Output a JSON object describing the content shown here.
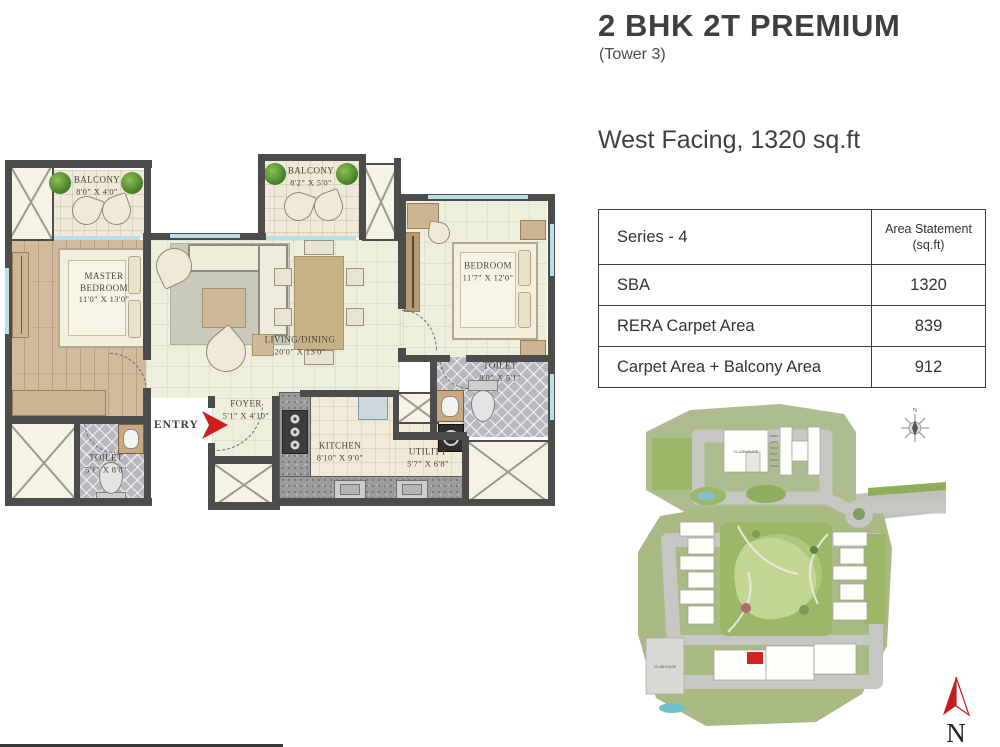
{
  "header": {
    "title": "2 BHK 2T PREMIUM",
    "subtitle": "(Tower 3)",
    "facing": "West Facing, 1320 sq.ft"
  },
  "area_table": {
    "series_header": "Series - 4",
    "area_header_line1": "Area Statement",
    "area_header_line2": "(sq.ft)",
    "rows": [
      {
        "label": "SBA",
        "value": "1320"
      },
      {
        "label": "RERA Carpet Area",
        "value": "839"
      },
      {
        "label": "Carpet Area + Balcony Area",
        "value": "912"
      }
    ]
  },
  "floor_plan": {
    "entry_label": "ENTRY",
    "rooms": [
      {
        "name": "BALCONY",
        "dims": "8'0\" X 4'0\""
      },
      {
        "name": "MASTER BEDROOM",
        "dims": "11'0\" X 13'0\""
      },
      {
        "name": "BALCONY",
        "dims": "8'2\" X 5'0\""
      },
      {
        "name": "LIVING/DINING",
        "dims": "20'0\" X 13'0\""
      },
      {
        "name": "BEDROOM",
        "dims": "11'7\" X 12'0\""
      },
      {
        "name": "TOILET",
        "dims": "8'0\" X 5'1\""
      },
      {
        "name": "TOILET",
        "dims": "5'1\" X 8'0\""
      },
      {
        "name": "FOYER",
        "dims": "5'1\" X 4'10\""
      },
      {
        "name": "KITCHEN",
        "dims": "8'10\" X 9'0\""
      },
      {
        "name": "UTILITY",
        "dims": "5'7\" X 6'8\""
      }
    ]
  },
  "site_map": {
    "clubhouse_top": "CLUBHOUSE",
    "clubhouse_bottom": "CLUBHOUSE",
    "compass_n": "N",
    "north_arrow_label": "N"
  },
  "colors": {
    "wall": "#4c4c4c",
    "entry_red": "#cf1d1d",
    "window_blue": "#b9e0ea",
    "table_border": "#3e3e3e"
  }
}
